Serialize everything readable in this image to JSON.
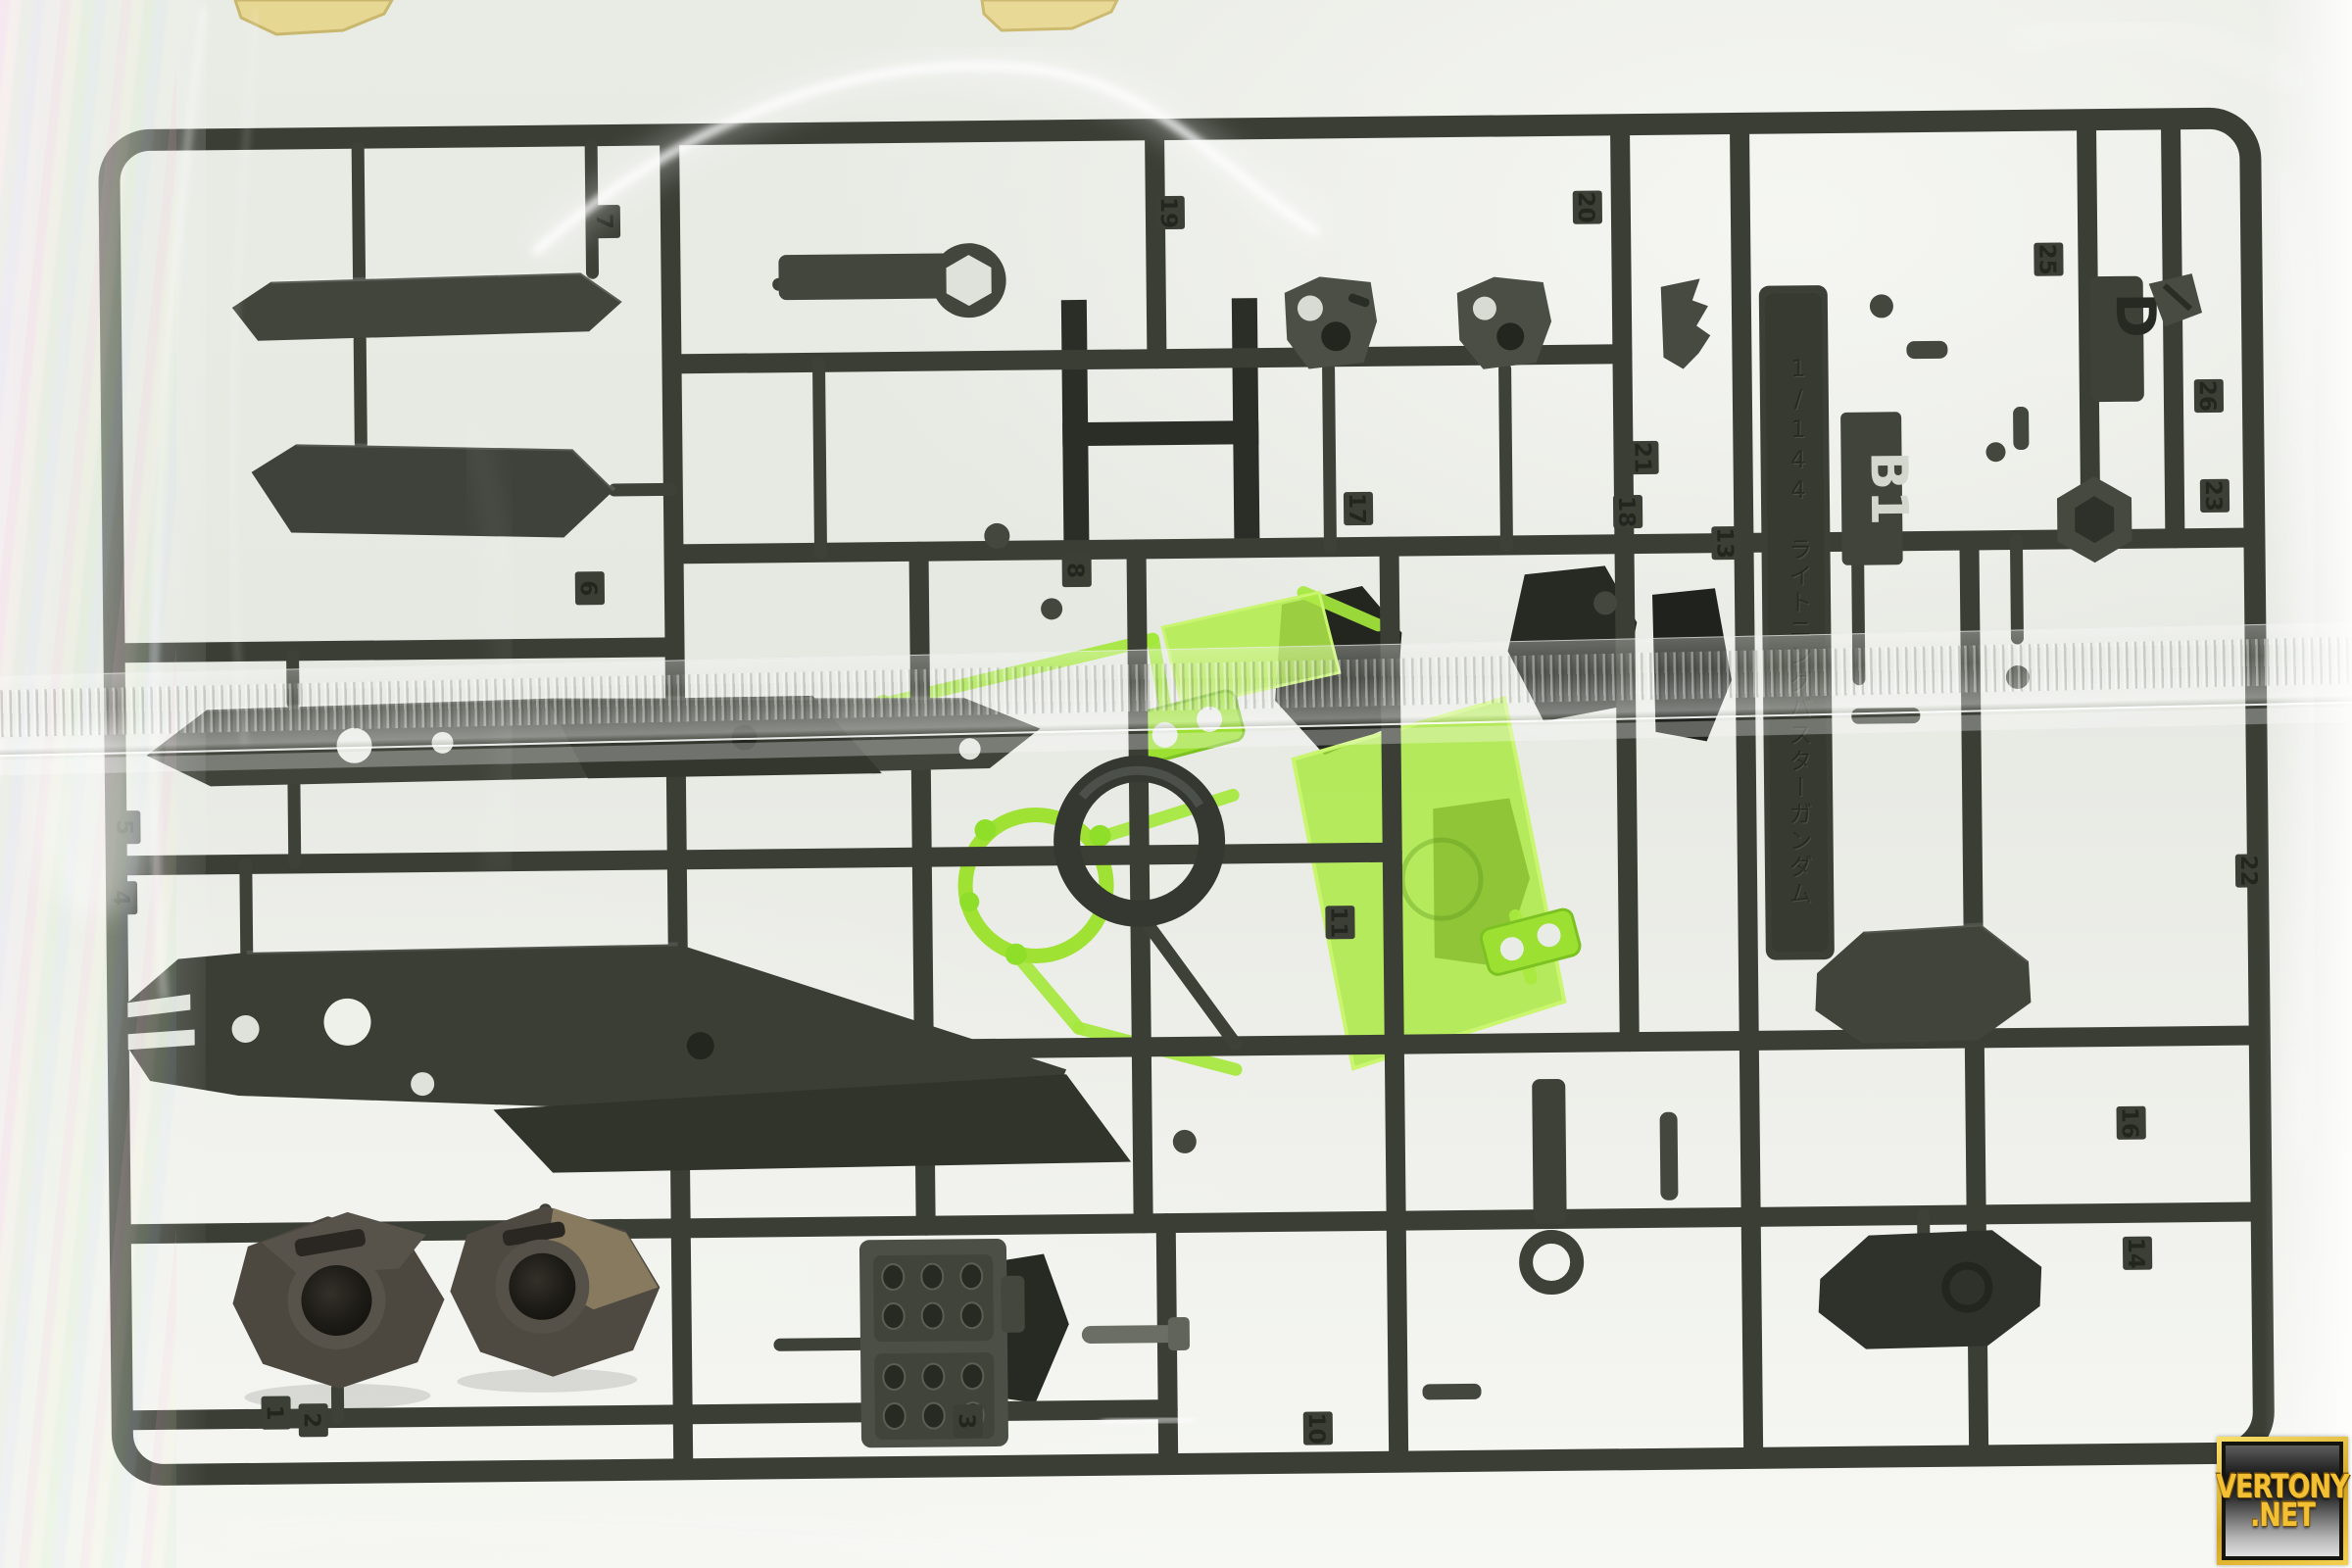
{
  "photo": {
    "subject": "Gundam plastic model kit runner sealed in a clear plastic bag",
    "name_plate_text": "1/144 ライトニングバスターガンダム",
    "runner_code": "B1",
    "mold_letter": "D",
    "tabs": [
      "1",
      "2",
      "3",
      "4",
      "5",
      "6",
      "7",
      "8",
      "10",
      "11",
      "13",
      "14",
      "16",
      "17",
      "18",
      "19",
      "20",
      "21",
      "22",
      "23",
      "25",
      "26"
    ],
    "colors": {
      "bag_background": "#e9ebe5",
      "sprue_dark": "#3a3e35",
      "sprue_part_light": "#4b4f45",
      "clear_green": "#a5e73c",
      "pale_yellow_part": "#e6d793",
      "watermark_gold": "#f3c033"
    }
  },
  "watermark": {
    "line1": "VERTONY",
    "line2": ".NET"
  }
}
